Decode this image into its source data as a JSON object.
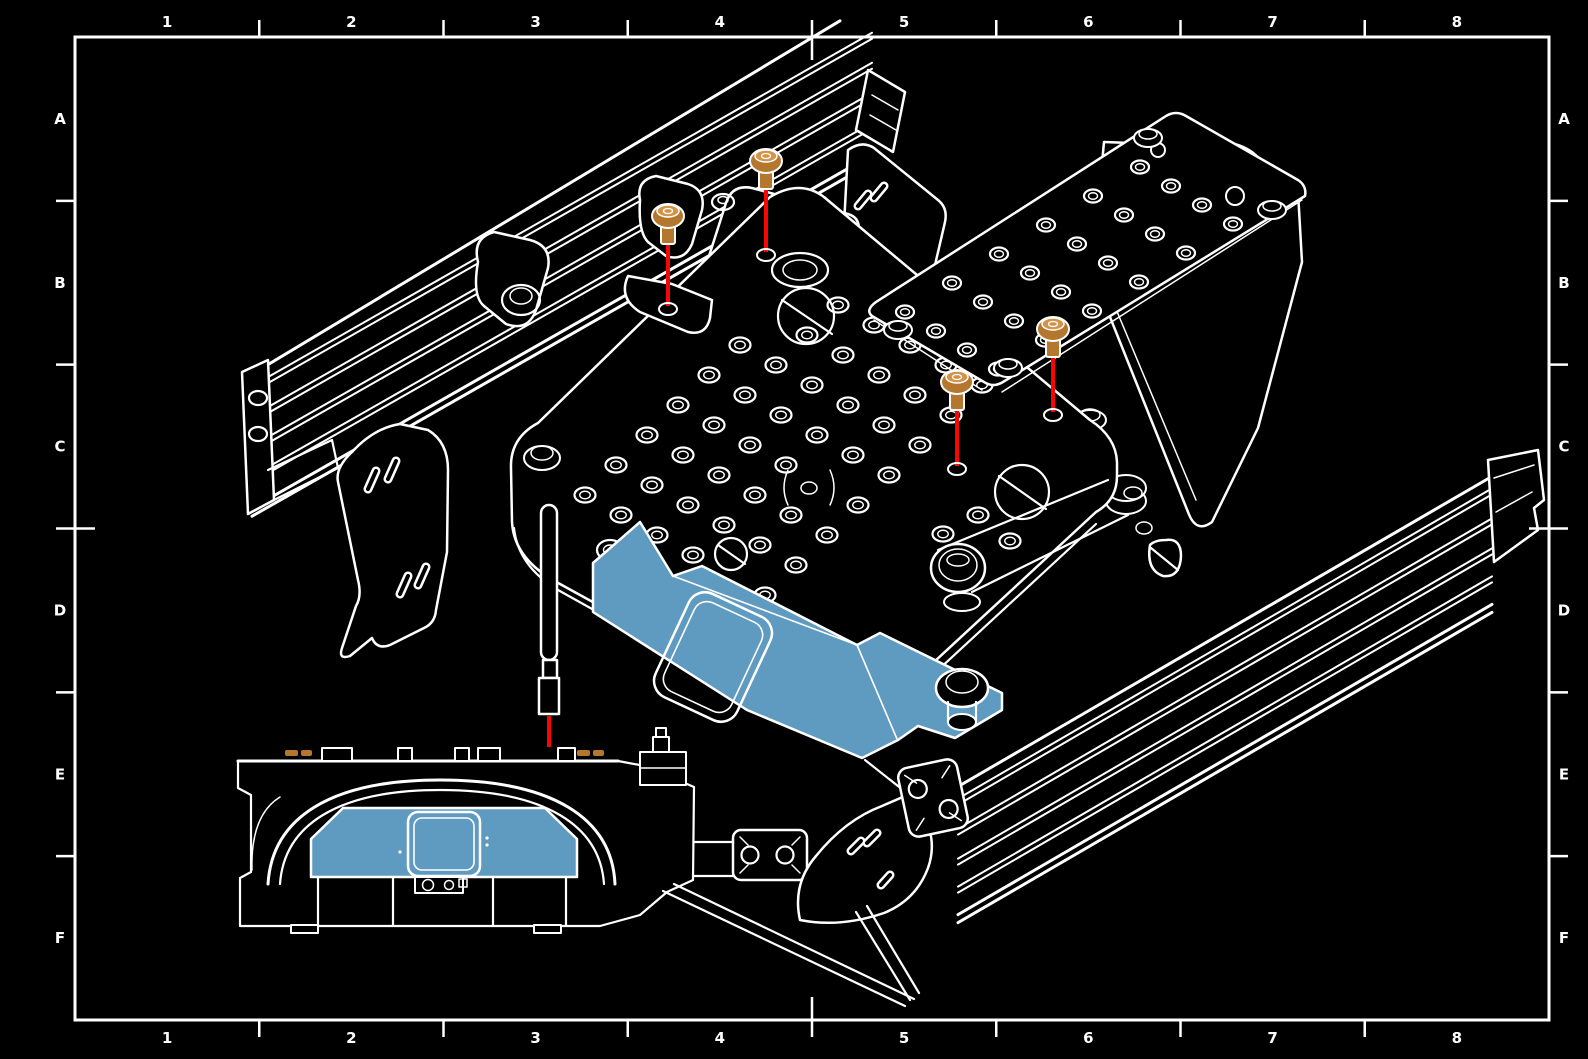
{
  "document": {
    "type": "technical-drawing-exploded-isometric-assembly",
    "sheet": {
      "background_color": "#000000",
      "line_color": "#ffffff",
      "border": {
        "x": 75,
        "y": 37,
        "width": 1474,
        "height": 983
      },
      "grid_columns": [
        "1",
        "2",
        "3",
        "4",
        "5",
        "6",
        "7",
        "8"
      ],
      "grid_rows": [
        "A",
        "B",
        "C",
        "D",
        "E",
        "F"
      ]
    },
    "highlight_color": "#5f9ac0",
    "fastener_color": "#b5762e",
    "fastener_highlight_color": "#d3944a",
    "leader_line_color": "#f80505",
    "callouts": {
      "screws": [
        {
          "name": "button-head-screw-1",
          "x": 668,
          "head_y": 216,
          "leader_end_y": 306
        },
        {
          "name": "button-head-screw-2",
          "x": 766,
          "head_y": 161,
          "leader_end_y": 252
        },
        {
          "name": "button-head-screw-3",
          "x": 957,
          "head_y": 382,
          "leader_end_y": 466
        },
        {
          "name": "button-head-screw-4",
          "x": 1053,
          "head_y": 329,
          "leader_end_y": 412
        }
      ],
      "antenna": {
        "x": 549,
        "leader_y1": 716,
        "leader_y2": 747
      },
      "front_view_fastener_marks": [
        [
          285,
          750,
          13
        ],
        [
          301,
          750,
          11
        ],
        [
          577,
          750,
          13
        ],
        [
          593,
          750,
          11
        ]
      ]
    },
    "hole_patterns": {
      "deck_plate": {
        "base": [
          585,
          495
        ],
        "e1": [
          31,
          -30
        ],
        "e2": [
          36,
          20
        ],
        "count1": 8,
        "count2": 6,
        "rx": 10.5,
        "ry": 7.5,
        "skip": [
          [
            6,
            0
          ],
          [
            7,
            0
          ],
          [
            3,
            4
          ],
          [
            0,
            4
          ]
        ],
        "extra": [
          [
            1010,
            541
          ],
          [
            978,
            515
          ],
          [
            943,
            534
          ]
        ],
        "edge_holes": [
          [
            610,
            550
          ],
          [
            690,
            597
          ],
          [
            768,
            643
          ],
          [
            845,
            690
          ]
        ]
      },
      "top_plate": {
        "base": [
          905,
          312
        ],
        "e1": [
          47,
          -29
        ],
        "e2": [
          31,
          19
        ],
        "count1": 6,
        "count2": 4,
        "rx": 9,
        "ry": 6.5,
        "lone_circles": [
          [
            1158,
            150,
            7
          ],
          [
            1235,
            196,
            9
          ]
        ]
      }
    }
  }
}
